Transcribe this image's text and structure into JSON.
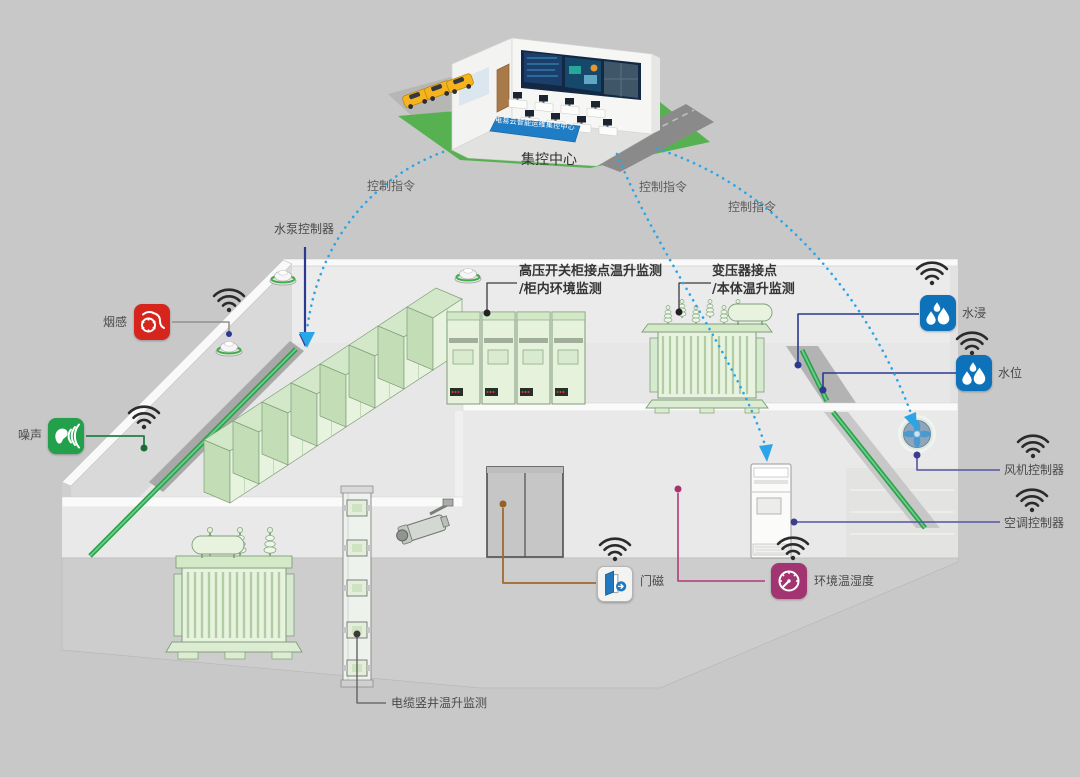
{
  "background_color": "#c8c8c8",
  "control_center": {
    "label": "集控中心",
    "banner": "电易云智能运维集控中心"
  },
  "command_flows": [
    {
      "label": "控制指令"
    },
    {
      "label": "控制指令"
    },
    {
      "label": "控制指令"
    }
  ],
  "controllers": {
    "water_pump": "水泵控制器",
    "fan": "风机控制器",
    "air_conditioner": "空调控制器"
  },
  "sensors": {
    "smoke": "烟感",
    "noise": "噪声",
    "flood": "水浸",
    "water_level": "水位",
    "door_magnet": "门磁",
    "env_temp_humidity": "环境温湿度"
  },
  "monitoring": {
    "switchgear_line1": "高压开关柜接点温升监测",
    "switchgear_line2": "/柜内环境监测",
    "transformer_line1": "变压器接点",
    "transformer_line2": "/本体温升监测",
    "cable_shaft": "电缆竖井温升监测"
  },
  "icons": {
    "smoke": "smoke-swirl-icon",
    "noise": "ear-sound-waves-icon",
    "flood": "water-drops-icon",
    "water_level": "water-drops-icon",
    "door_magnet": "open-door-arrow-icon",
    "env_temp_humidity": "gauge-icon",
    "wifi": "wifi-icon",
    "fan": "fan-blades-icon",
    "smoke_detector": "smoke-detector-dome-icon",
    "camera": "cctv-camera-icon"
  },
  "colors": {
    "command_flow_blue": "#29a5e8",
    "pump_arrow_navy": "#2b3990",
    "water_line_navy": "#2b3990",
    "controller_line_slate": "#55559f",
    "env_line_magenta": "#b23a78",
    "door_line_brown": "#a06a2c",
    "noise_line_green": "#1f8044",
    "smoke_icon_red": "#d5251c",
    "noise_icon_green": "#22a04b",
    "water_icon_blue": "#0d72b9",
    "env_icon_purple": "#a23571",
    "equipment_green": "#e7f3de",
    "cable_green": "#3cb54a",
    "lawn_green": "#58b150",
    "banner_blue": "#1e7dc4"
  }
}
